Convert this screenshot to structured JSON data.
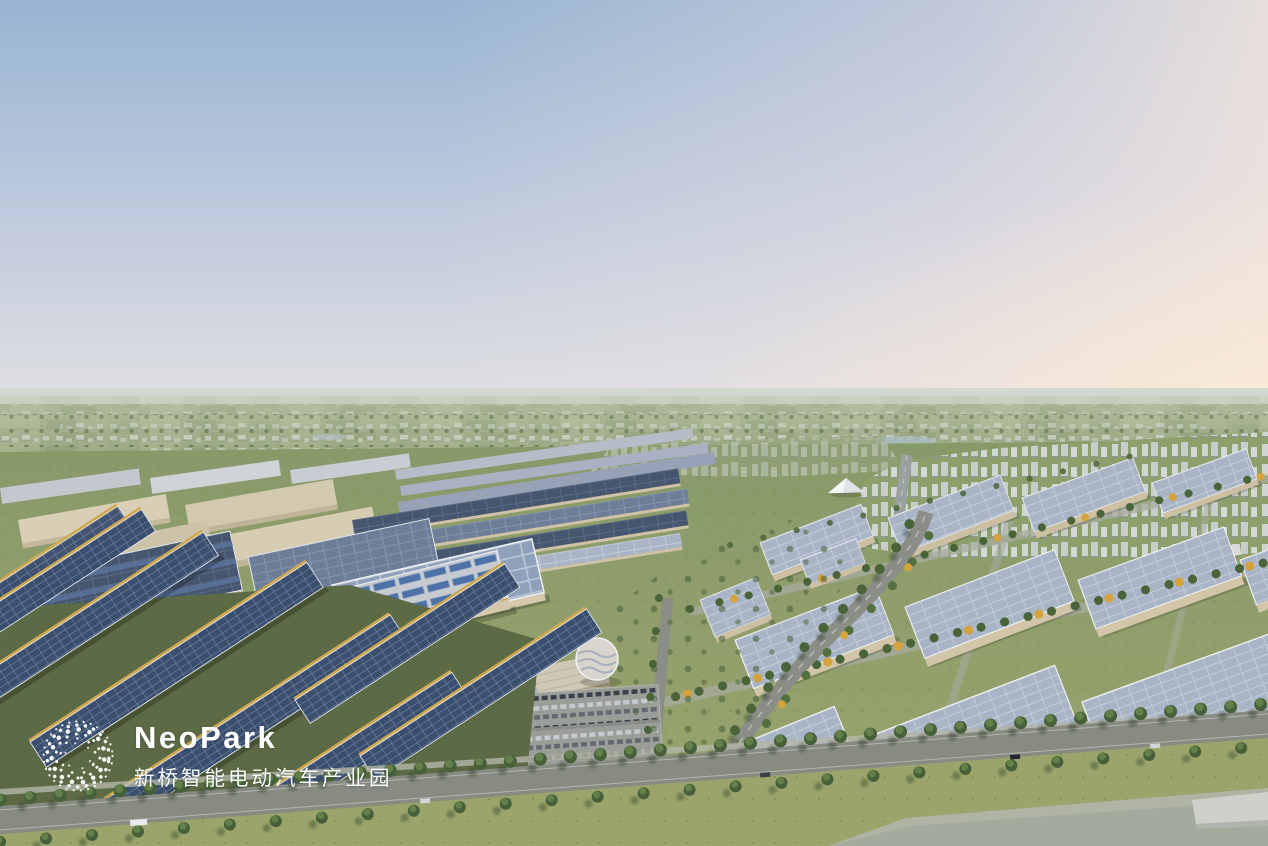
{
  "logo": {
    "brand": "NeoPark",
    "subtitle": "新桥智能电动汽车产业园"
  },
  "scene": {
    "palette": {
      "sky_top": "#98b4d2",
      "sky_mid": "#c3cdde",
      "sky_bottom": "#e4e2e3",
      "sunset_glow": "#f9e9d5",
      "field_green": "#8d9c74",
      "park_green": "#879a6b",
      "lawn_green": "#9aa46b",
      "tree_green": "#46603a",
      "tree_yellow": "#d4a33c",
      "solar_dark": "#46566f",
      "solar_light": "#a9b4c6",
      "roof_beige": "#d6c9ac",
      "gold_edge": "#c9a24a",
      "road_gray": "#878b82",
      "water_gray": "#a5ab9c",
      "city_white": "#d7dbdd"
    }
  }
}
